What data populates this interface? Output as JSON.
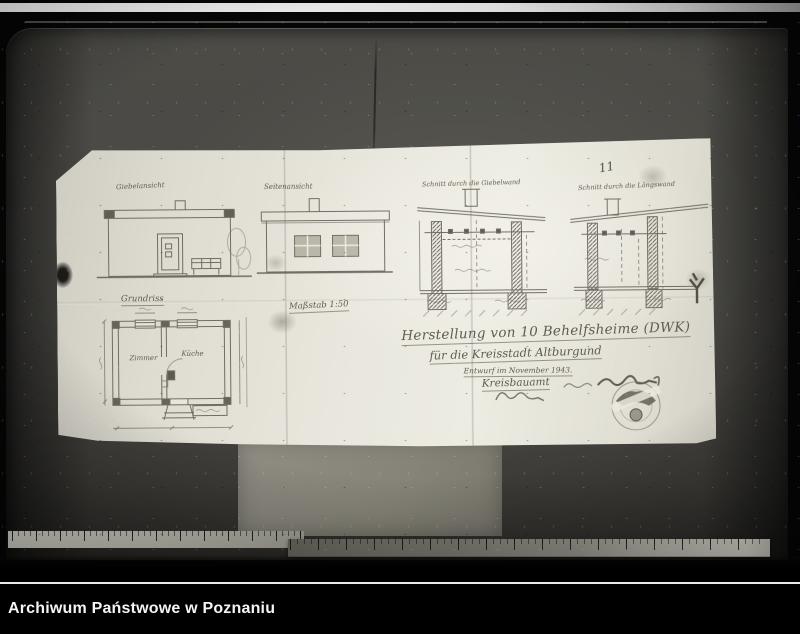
{
  "caption_bar": {
    "title": "Archiwum Państwowe w Poznaniu"
  },
  "photograph": {
    "page_number": "11",
    "blueprint": {
      "labels": {
        "elevation_front": "Giebelansicht",
        "elevation_side": "Seitenansicht",
        "section_left": "Schnitt durch die Giebelwand",
        "section_right": "Schnitt durch die Längswand",
        "floor_plan": "Grundriss",
        "room_left": "Zimmer",
        "room_right": "Küche",
        "scale": "Maßstab 1:50"
      },
      "title_block": {
        "line1": "Herstellung von 10 Behelfsheime (DWK)",
        "line2": "für die Kreisstadt Altburgund",
        "line3": "Entwurf im November 1943.",
        "line4": "Kreisbauamt"
      }
    },
    "colors": {
      "paper": "#e9e7dd",
      "table": "#4c4b46",
      "pencil": "#5c5950",
      "frame": "#000000"
    }
  }
}
